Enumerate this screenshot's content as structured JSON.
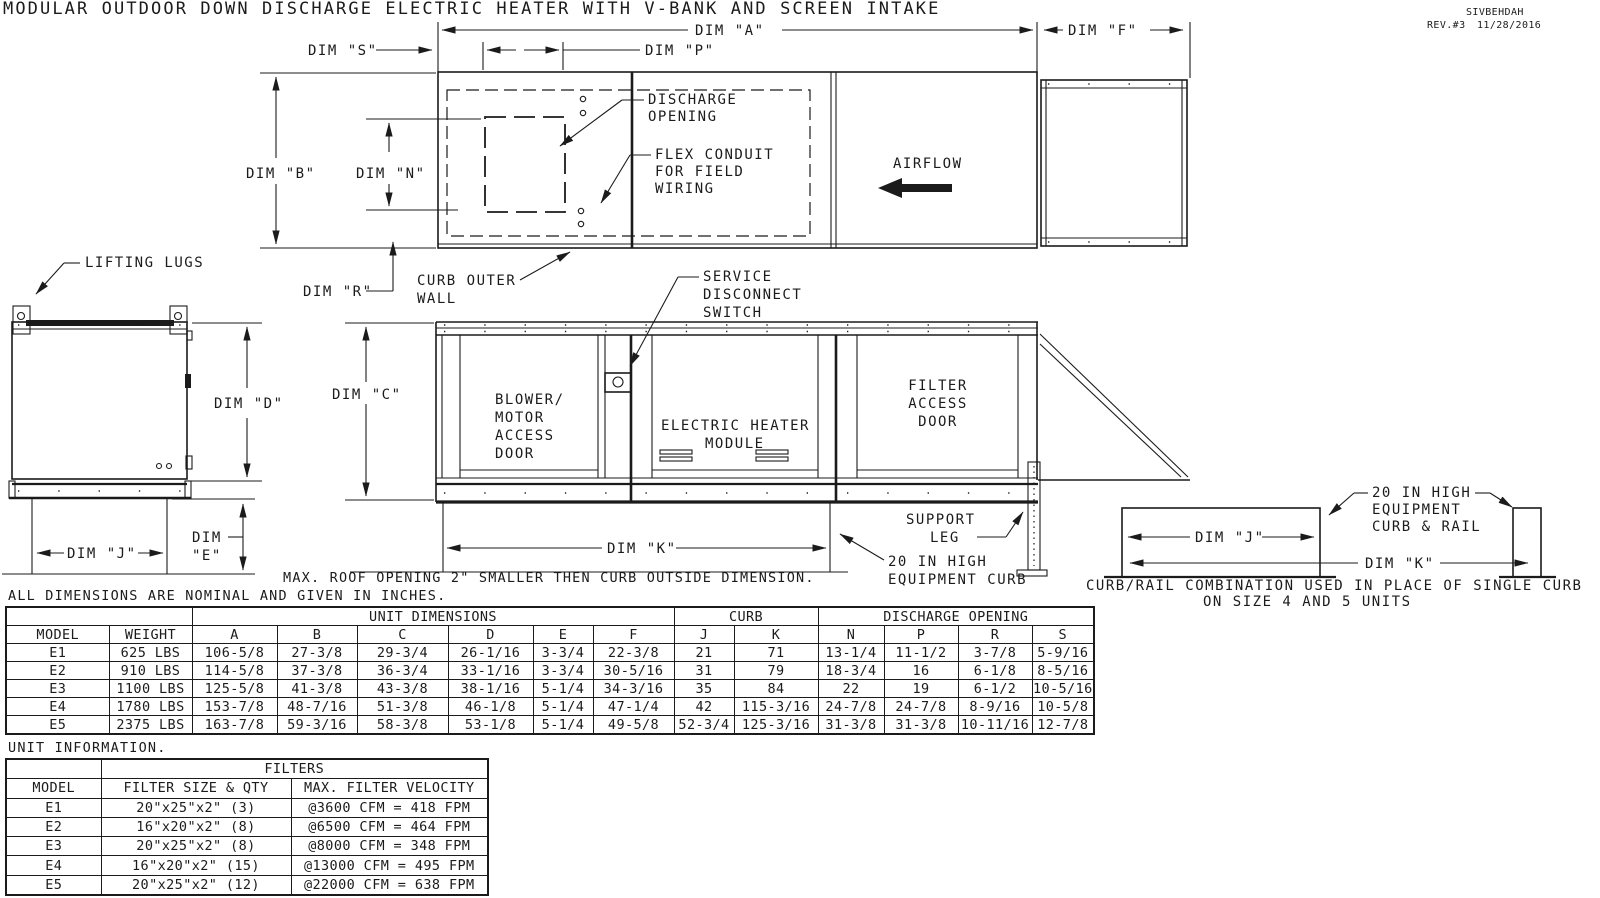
{
  "title": "MODULAR OUTDOOR DOWN DISCHARGE ELECTRIC HEATER WITH V-BANK AND SCREEN INTAKE",
  "revision": {
    "code": "SIVBEHDAH",
    "rev": "REV.#3",
    "date": "11/28/2016"
  },
  "colors": {
    "line": "#1b1b1b",
    "background": "#ffffff"
  },
  "drawing": {
    "dims": {
      "a": "DIM \"A\"",
      "b": "DIM \"B\"",
      "c": "DIM \"C\"",
      "d": "DIM \"D\"",
      "e1": "DIM",
      "e2": "\"E\"",
      "f": "DIM \"F\"",
      "j": "DIM \"J\"",
      "k": "DIM \"K\"",
      "n": "DIM \"N\"",
      "p": "DIM \"P\"",
      "r": "DIM \"R\"",
      "s": "DIM \"S\""
    },
    "labels": {
      "lifting_lugs": "LIFTING LUGS",
      "discharge_opening": [
        "DISCHARGE",
        "OPENING"
      ],
      "flex_conduit": [
        "FLEX CONDUIT",
        "FOR FIELD",
        "WIRING"
      ],
      "airflow": "AIRFLOW",
      "curb_outer_wall": [
        "CURB OUTER",
        "WALL"
      ],
      "service_disconnect": [
        "SERVICE",
        "DISCONNECT",
        "SWITCH"
      ],
      "blower_door": [
        "BLOWER/",
        "MOTOR",
        "ACCESS",
        "DOOR"
      ],
      "heater_module": [
        "ELECTRIC HEATER",
        "MODULE"
      ],
      "filter_door": [
        "FILTER",
        "ACCESS",
        "DOOR"
      ],
      "support_leg": [
        "SUPPORT",
        "LEG"
      ],
      "equipment_curb": [
        "20 IN HIGH",
        "EQUIPMENT CURB"
      ],
      "curb_rail": [
        "20 IN HIGH",
        "EQUIPMENT",
        "CURB & RAIL"
      ],
      "curb_rail_caption": [
        "CURB/RAIL COMBINATION USED IN PLACE OF SINGLE CURB",
        "ON SIZE 4 AND 5 UNITS"
      ]
    },
    "notes": {
      "roof_opening": "MAX. ROOF OPENING 2\" SMALLER THEN CURB OUTSIDE DIMENSION.",
      "nominal": "ALL DIMENSIONS ARE NOMINAL AND GIVEN IN INCHES.",
      "unit_information": "UNIT INFORMATION."
    }
  },
  "dim_table": {
    "groups": {
      "unit_dimensions": "UNIT DIMENSIONS",
      "curb": "CURB",
      "discharge_opening": "DISCHARGE OPENING"
    },
    "columns": [
      "MODEL",
      "WEIGHT",
      "A",
      "B",
      "C",
      "D",
      "E",
      "F",
      "J",
      "K",
      "N",
      "P",
      "R",
      "S"
    ],
    "rows": [
      [
        "E1",
        "625 LBS",
        "106-5/8",
        "27-3/8",
        "29-3/4",
        "26-1/16",
        "3-3/4",
        "22-3/8",
        "21",
        "71",
        "13-1/4",
        "11-1/2",
        "3-7/8",
        "5-9/16"
      ],
      [
        "E2",
        "910 LBS",
        "114-5/8",
        "37-3/8",
        "36-3/4",
        "33-1/16",
        "3-3/4",
        "30-5/16",
        "31",
        "79",
        "18-3/4",
        "16",
        "6-1/8",
        "8-5/16"
      ],
      [
        "E3",
        "1100 LBS",
        "125-5/8",
        "41-3/8",
        "43-3/8",
        "38-1/16",
        "5-1/4",
        "34-3/16",
        "35",
        "84",
        "22",
        "19",
        "6-1/2",
        "10-5/16"
      ],
      [
        "E4",
        "1780 LBS",
        "153-7/8",
        "48-7/16",
        "51-3/8",
        "46-1/8",
        "5-1/4",
        "47-1/4",
        "42",
        "115-3/16",
        "24-7/8",
        "24-7/8",
        "8-9/16",
        "10-5/8"
      ],
      [
        "E5",
        "2375 LBS",
        "163-7/8",
        "59-3/16",
        "58-3/8",
        "53-1/8",
        "5-1/4",
        "49-5/8",
        "52-3/4",
        "125-3/16",
        "31-3/8",
        "31-3/8",
        "10-11/16",
        "12-7/8"
      ]
    ]
  },
  "filter_table": {
    "group": "FILTERS",
    "columns": [
      "MODEL",
      "FILTER SIZE & QTY",
      "MAX. FILTER VELOCITY"
    ],
    "rows": [
      [
        "E1",
        "20\"x25\"x2\" (3)",
        "@3600 CFM = 418 FPM"
      ],
      [
        "E2",
        "16\"x20\"x2\" (8)",
        "@6500 CFM = 464 FPM"
      ],
      [
        "E3",
        "20\"x25\"x2\" (8)",
        "@8000 CFM = 348 FPM"
      ],
      [
        "E4",
        "16\"x20\"x2\" (15)",
        "@13000 CFM = 495 FPM"
      ],
      [
        "E5",
        "20\"x25\"x2\" (12)",
        "@22000 CFM = 638 FPM"
      ]
    ]
  }
}
